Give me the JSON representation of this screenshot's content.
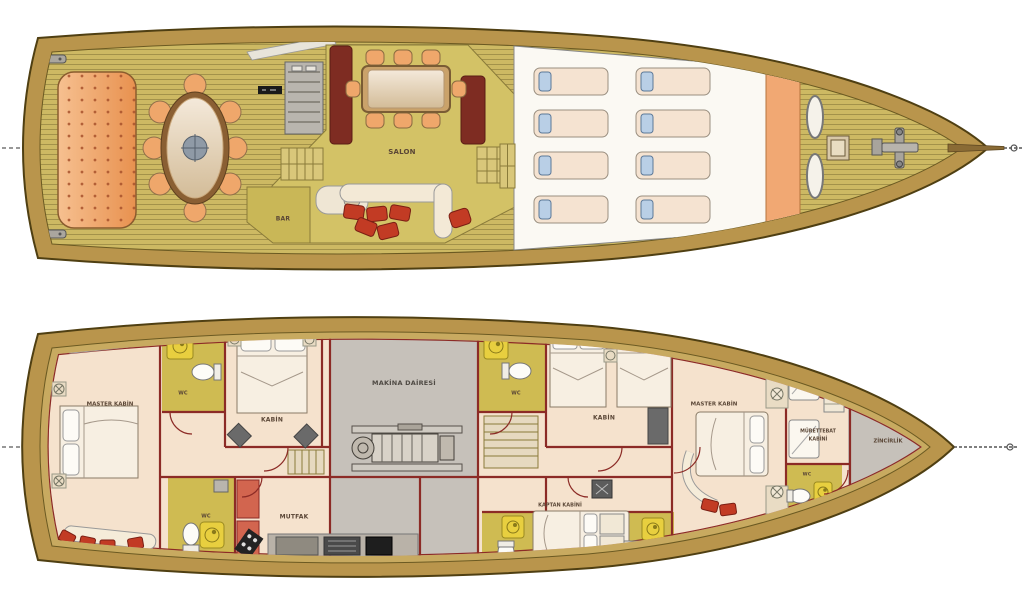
{
  "plan": {
    "upper_deck": {
      "salon_label": "SALON",
      "bar_label": "BAR"
    },
    "lower_deck": {
      "master_aft_label": "MASTER KABİN",
      "wc_aft_label": "WC",
      "cabin_aft_label": "KABİN",
      "wc_galley_label": "WC",
      "galley_label": "MUTFAK",
      "engine_room_label": "MAKİNA DAİRESİ",
      "wc_mid_label": "WC",
      "cabin_fwd_label": "KABİN",
      "master_fwd_label": "MASTER KABİN",
      "captain_label": "KAPTAN KABİNİ",
      "wc_fwd_label": "WC",
      "crew_label_line1": "MÜRETTEBAT",
      "crew_label_line2": "KABİNİ",
      "chain_locker_label": "ZİNCİRLİK"
    },
    "colors": {
      "deck_plank": "#cdb963",
      "hull_trim": "#b9954c",
      "salon_floor": "#d3c266",
      "cabin_floor": "#f5e2cd",
      "wc_floor": "#cfbb52",
      "engine_gray": "#c6c1ba",
      "wall_red": "#8c2b26",
      "cushion_red": "#c23b24",
      "furniture_orange": "#efa76b",
      "pillow_blue": "#b9cfe6"
    }
  }
}
